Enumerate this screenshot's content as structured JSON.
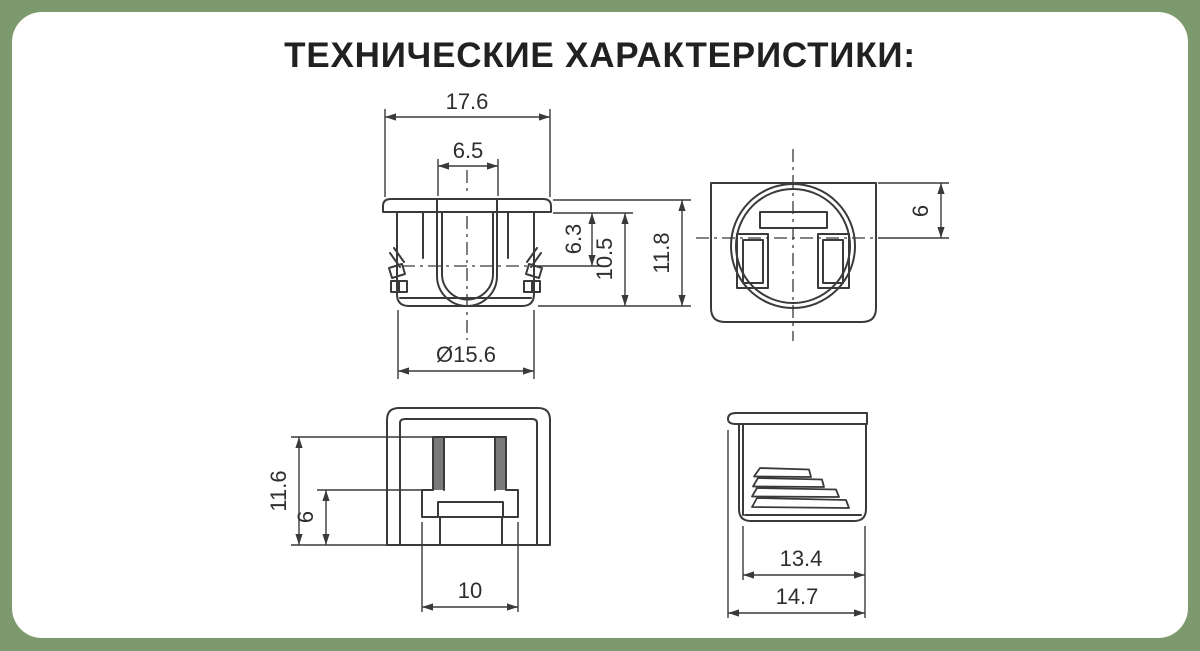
{
  "title": "ТЕХНИЧЕСКИЕ ХАРАКТЕРИСТИКИ:",
  "theme": {
    "background_color": "#7d9a6e",
    "card_color": "#ffffff",
    "line_color": "#3a3a3a",
    "text_color": "#2e2e2e"
  },
  "dims": {
    "front": {
      "outer_width": "17.6",
      "slot_width": "6.5",
      "lock_depth": "6.3",
      "body_height": "10.5",
      "total_height": "11.8",
      "diameter": "Ø15.6"
    },
    "top": {
      "flange_offset": "6"
    },
    "side": {
      "height": "11.6",
      "lower_height": "6",
      "foot_width": "10"
    },
    "back": {
      "body_width": "13.4",
      "overall_width": "14.7"
    }
  }
}
